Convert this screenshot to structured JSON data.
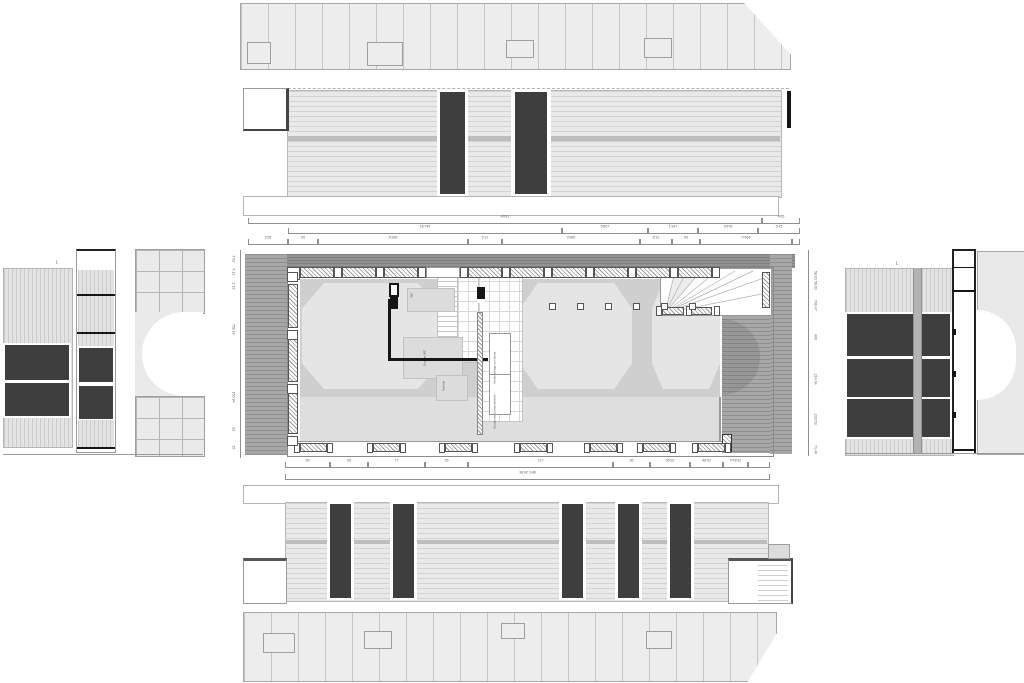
{
  "section_marker": "1",
  "dims": {
    "top_row1": [
      "49'81",
      "4'65"
    ],
    "top_row2": [
      "16'745",
      "5'807",
      "1'947",
      "9'675",
      "5'75"
    ],
    "top_row3": [
      "2'95",
      "95",
      "8'285",
      "5'12",
      "0'985",
      "5'12",
      "95",
      "0'964",
      ""
    ],
    "bottom_row": [
      "95",
      "95",
      "77",
      "95",
      "717",
      "95",
      "95'92",
      "48'92",
      "4'78'92",
      ""
    ],
    "bottom_total": "38'42 1/46",
    "left_col": [
      "4.62",
      "4.12",
      "2.13",
      "758.10",
      "150.84",
      "92",
      "15"
    ],
    "right_col": [
      "58.01",
      "58.01",
      "708.47",
      "400",
      "214.04",
      "233.53",
      "71.40"
    ]
  },
  "rooms": {
    "wc": "WC",
    "shower": "Dusche WC",
    "technik": "Technik",
    "wardrobe": "Kleiderablage mit Spind",
    "lockers": "Garderobe Schliessfächer"
  }
}
